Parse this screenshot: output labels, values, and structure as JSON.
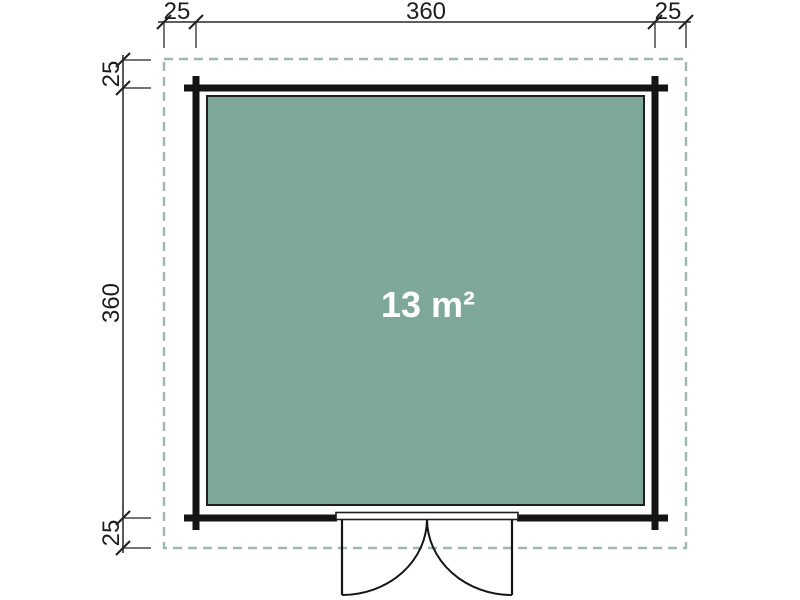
{
  "meta": {
    "type": "floor-plan",
    "description": "Top-down floor plan of a square garden building with double doors"
  },
  "plan": {
    "area_label": "13 m²",
    "dimensions": {
      "top": [
        "25",
        "360",
        "25"
      ],
      "left": [
        "25",
        "360",
        "25"
      ]
    },
    "colors": {
      "interior_fill": "#7EA899",
      "overhang_dash": "#9DB8B0",
      "wall": "#141414",
      "dimension_line": "#474747",
      "dimension_text": "#1E1E1E",
      "area_text": "#FFFFFF",
      "background": "#FFFFFF"
    }
  }
}
